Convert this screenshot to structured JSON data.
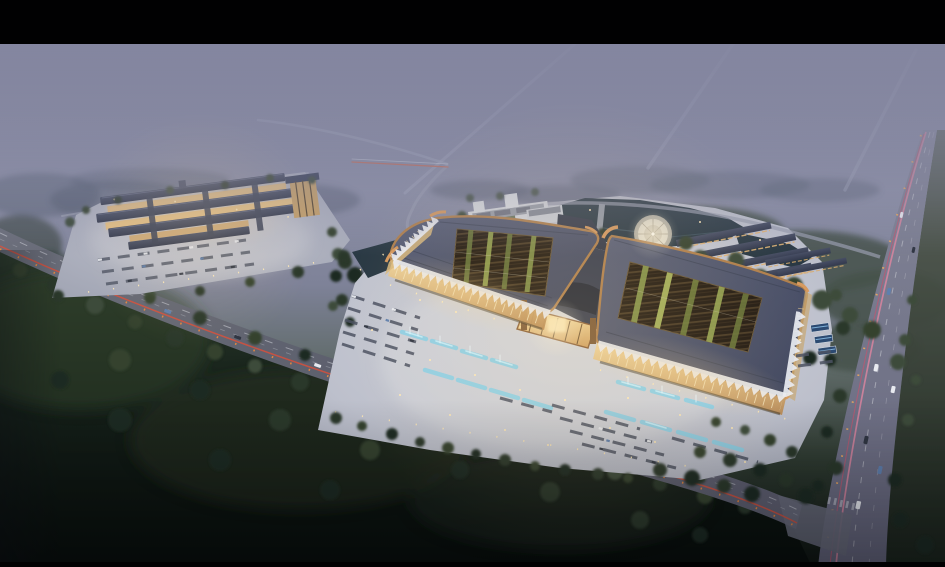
{
  "scene": {
    "label": "Aerial dusk rendering of an exhibition-center campus with twin courtyard halls, lit plazas, boulevard light trails, fog and forest",
    "type": "architectural-aerial-rendering",
    "time_of_day": "dusk",
    "regions": [
      {
        "id": "letterbox-top",
        "label": "black letterbox bar"
      },
      {
        "id": "foggy-horizon",
        "label": "purple fog with distant roads"
      },
      {
        "id": "left-retail-complex",
        "label": "lit low-rise retail complex"
      },
      {
        "id": "twin-hall-building",
        "label": "twin halls with roof-garden courtyards and copper eaves"
      },
      {
        "id": "central-atrium",
        "label": "glowing central atrium"
      },
      {
        "id": "pond",
        "label": "landscape pond"
      },
      {
        "id": "circular-fountain",
        "label": "round fountain plaza"
      },
      {
        "id": "north-office-building",
        "label": "white office building"
      },
      {
        "id": "east-building-rows",
        "label": "rows of service buildings"
      },
      {
        "id": "main-plaza",
        "label": "parking plaza with fountains"
      },
      {
        "id": "boulevard-road",
        "label": "diagonal boulevard with tail-light trail"
      },
      {
        "id": "highway-road",
        "label": "highway with pink light trails"
      },
      {
        "id": "south-forest",
        "label": "dark forest foreground"
      },
      {
        "id": "letterbox-bottom",
        "label": "black letterbox bar"
      }
    ]
  },
  "palette": {
    "letterbox": "#010102",
    "fog_top": "#83859d",
    "fog_mid": "#8d90a7",
    "plaza_main": "#c6c8d2",
    "plaza_left": "#b2b5c2",
    "roof_slate": "#4b5166",
    "roof_dark": "#3a4156",
    "copper": "#b0804e",
    "lattice_dark": "#251d15",
    "planting_green": "#74823f",
    "facade_warm": "#e9c98c",
    "atrium_glow": "#f2d896",
    "canopy_white": "#e9ecf2",
    "pond": "#2a3944",
    "fountain_pad": "#ddd8c8",
    "forest_top": "#2c3a2c",
    "forest_deep": "#0a100c",
    "road_surface": "#61646f",
    "road_vertical": "#6e7085",
    "taillight_red": "#d6503c",
    "lamp_orange": "#f08a3c",
    "trail_pink": "#e687a2",
    "car_white": "#e8eaf0",
    "car_blue": "#5e7fae",
    "car_dark": "#2f3542",
    "water_feature": "#8fd0e6",
    "light_warm": "#ffe9b8"
  }
}
